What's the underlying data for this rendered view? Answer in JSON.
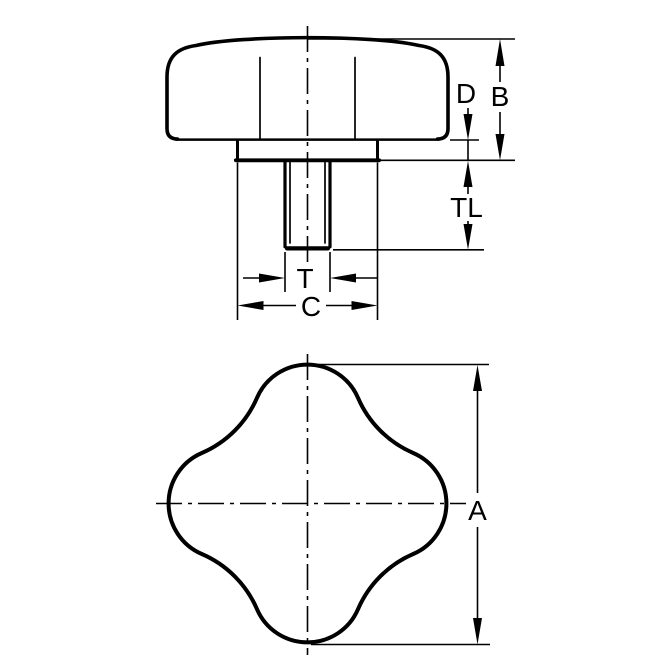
{
  "drawing": {
    "background": "#ffffff",
    "line_color": "#000000",
    "side_view": {
      "dim_d": "D",
      "dim_b": "B",
      "dim_tl": "TL",
      "dim_t": "T",
      "dim_c": "C"
    },
    "plan_view": {
      "dim_a": "A"
    }
  }
}
